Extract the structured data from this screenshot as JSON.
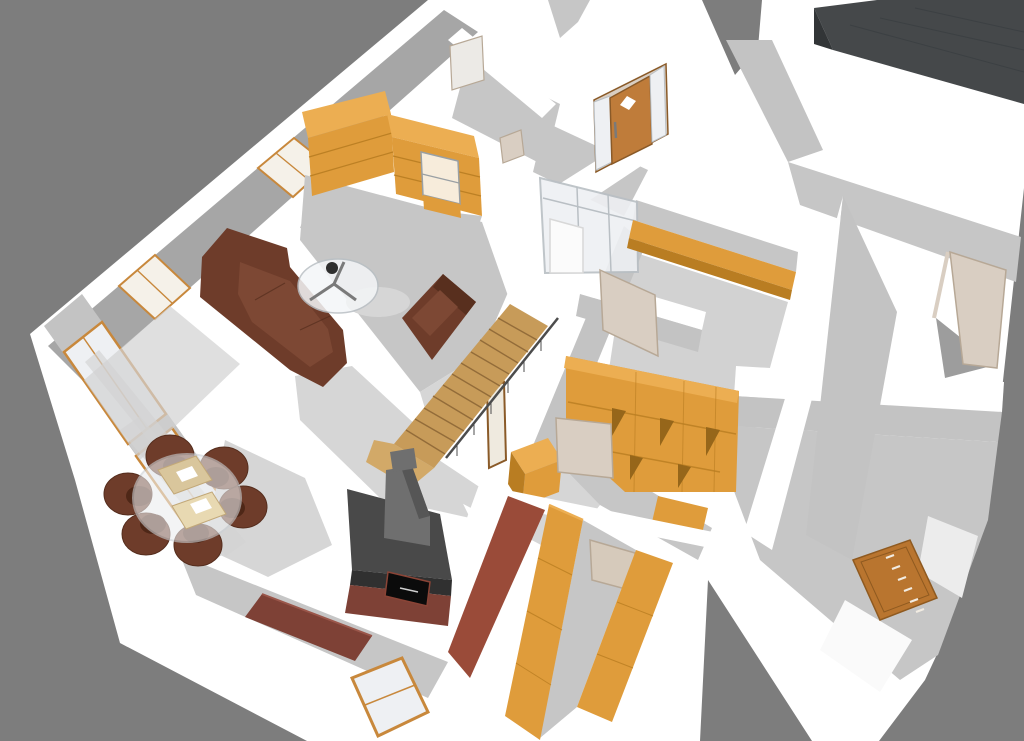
{
  "viewport": {
    "description": "3D bird's-eye rendering of a furnished single-storey house floor plan",
    "width_px": 1024,
    "height_px": 741,
    "background": "#7d7d7d"
  },
  "palette": {
    "bg": "#7d7d7d",
    "white": "#ffffff",
    "offWhite": "#fafafa",
    "patchGray": "#ececec",
    "wallFace": "#c3c3c3",
    "wallFaceDark": "#a6a6a6",
    "floorShadow": "#c6c6c6",
    "floorShadowLight": "#d6d6d6",
    "floorShadowSoft": "#d2d2d2",
    "shadowGray": "#9d9d9d",
    "roof": "#45484a",
    "roofDark": "#323537",
    "roofLine": "#3c4043",
    "wood": "#df9c3b",
    "woodLight": "#ecae52",
    "woodDark": "#b97d22",
    "woodShadow": "#96661a",
    "frameWood": "#c8883c",
    "doorWood": "#bf7c3a",
    "doorWoodDark": "#8a5a28",
    "stairWood": "#c79b59",
    "stairFlare": "#d2a968",
    "stairLine": "#8a6434",
    "railing": "#4c4c4c",
    "sofa": "#6e3c2a",
    "sofaDark": "#552d1d",
    "sofaLight": "#7d4834",
    "chairDark": "#4e2717",
    "glass": "#eef0f3",
    "glassWarm": "#f5f1e9",
    "glassStroke": "#b9bfc4",
    "metal": "#7a7a7a",
    "metalDark": "#2e2e2e",
    "stoveTop": "#494949",
    "stoveDark": "#303030",
    "stoveBody": "#6f6f6f",
    "stoveSide": "#565656",
    "cooktop": "#0b0b0b",
    "cooktopRim": "#8a4436",
    "maroon": "#7e4136",
    "maroonLight": "#9a564a",
    "redWall": "#9a4b39",
    "cream": "#d9cec2",
    "creamDark": "#b7a896",
    "creamDoor": "#d6cabb",
    "dresserWood": "#b9752f",
    "dresserLine": "#8f5a20",
    "dresserHandle": "#f2ece2",
    "tableDeco": "#d9c69c",
    "tableDecoLight": "#e8d9b2"
  },
  "scene": {
    "rooms": [
      "living room",
      "kitchen",
      "entrance hall with glazed vestibule",
      "staircase",
      "storage room with open shelving",
      "corridor with wardrobes",
      "right-wing rooms (unfurnished)"
    ],
    "objects": [
      "gray backdrop",
      "white house shell seen from above",
      "dark flat roof slab (top right)",
      "L-shaped brown sectional sofa",
      "brown loveseat",
      "round glass coffee table with metal frame",
      "round glass dining table with six brown tub chairs and beige place settings",
      "wooden staircase with dark handrail",
      "wood stove with metal flue, black oven door and brick-red base",
      "brick-red chimney wall",
      "dark-red sideboard",
      "orange kitchen cabinet run with counter window",
      "wooden front door with diamond window and glass sidelights",
      "glazed vestibule partition with white sliding door",
      "orange hallway half-wall",
      "orange open shelving unit",
      "cream interior doors",
      "two orange corridor wardrobes with wooden door",
      "floor-to-ceiling windows with wooden frames",
      "small window in bottom wall",
      "wooden chest of drawers",
      "open cream door in right wing"
    ]
  }
}
